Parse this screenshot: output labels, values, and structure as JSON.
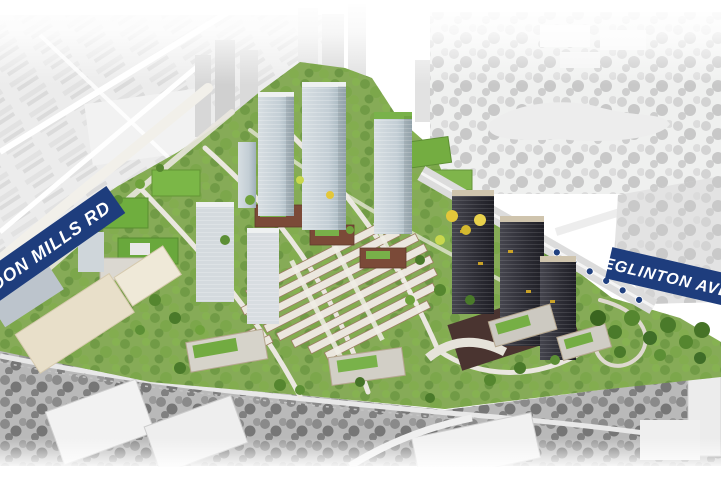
{
  "labels": {
    "road_left": "DON MILLS RD",
    "road_right": "EGLINTON AVE"
  },
  "colors": {
    "background": "#ffffff",
    "banner_blue": "#1e3d7d",
    "banner_text": "#ffffff",
    "transit_dot_blue": "#20407f",
    "site_green": "#86ab57",
    "tree_green_dark": "#3f6d28",
    "tree_green": "#55862f",
    "tree_green_light": "#8fc050",
    "tree_yellow": "#e3c73a",
    "glass_tower_gray": "#c5ced4",
    "dark_tower": "#2e2e36",
    "brick_red": "#7b4a38",
    "surrounding_gray": "#dadada",
    "rail_corridor_gray": "#b2b2b2"
  },
  "transit_stations": {
    "count": 7
  }
}
